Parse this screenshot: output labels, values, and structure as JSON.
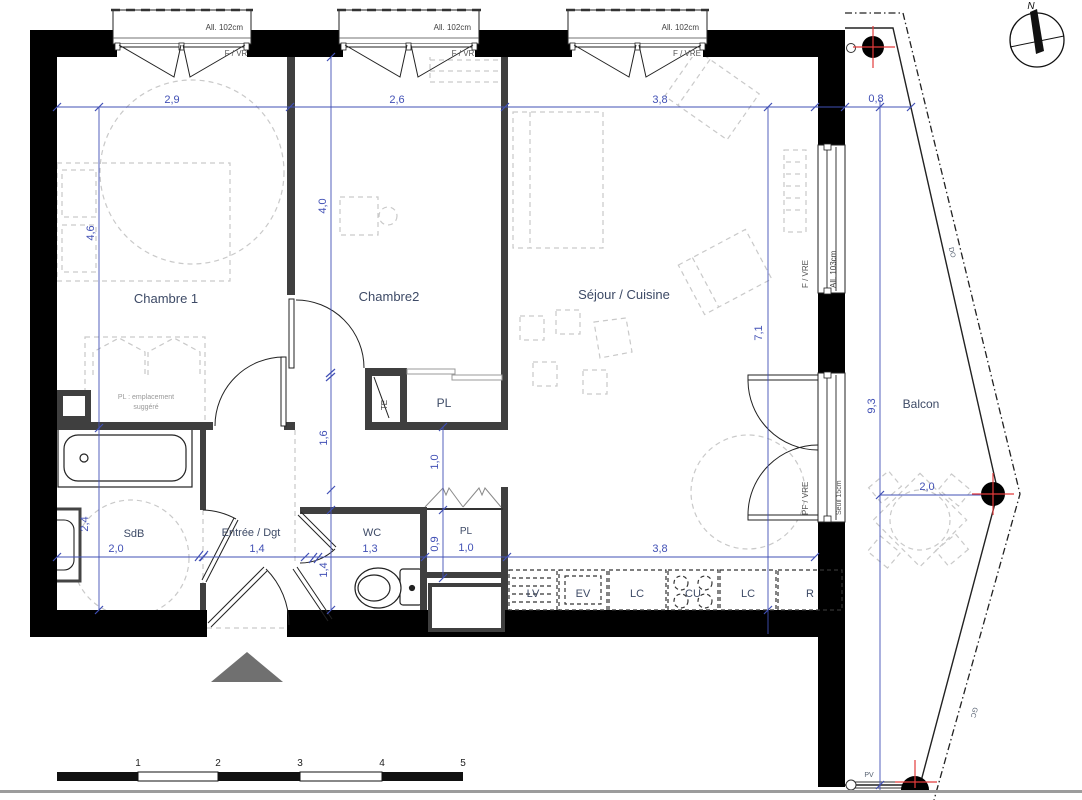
{
  "compass": {
    "label": "N"
  },
  "rooms": {
    "chambre1": "Chambre 1",
    "chambre2": "Chambre2",
    "sejour": "Séjour / Cuisine",
    "balcon": "Balcon",
    "sdb": "SdB",
    "entree": "Entrée / Dgt",
    "wc": "WC",
    "pl_chambre2": "PL",
    "pl_entree": "PL"
  },
  "openings": {
    "allege_102": "All. 102cm",
    "allege_103": "All. 103cm",
    "fvr": "F / VR",
    "fvre": "F / VRE",
    "pfvre": "PF / VRE",
    "seuil": "Seuil 15cm",
    "pv": "PV",
    "gc": "GC",
    "do": "DO"
  },
  "notes": {
    "te": "TE",
    "pl_sugg_1": "PL : emplacement",
    "pl_sugg_2": "suggéré"
  },
  "kitchen": {
    "units": [
      "LV",
      "EV",
      "LC",
      "CU",
      "LC",
      "R"
    ]
  },
  "dimensions": {
    "top": {
      "chambre1": "2,9",
      "chambre2": "2,6",
      "sejour": "3,8",
      "balcon": "0,8"
    },
    "left": {
      "chambre1": "4,6",
      "sdb": "2,4"
    },
    "middle": {
      "chambre2": "4,0",
      "hall": "1,6",
      "wc": "1,4"
    },
    "pl": {
      "depth_top": "1,0",
      "depth": "0,9"
    },
    "sejour_height": "7,1",
    "bottom": {
      "sdb": "2,0",
      "entree": "1,4",
      "wc": "1,3",
      "pl": "1,0",
      "cuisine": "3,8"
    },
    "balcon": {
      "height": "9,3",
      "width": "2,0"
    }
  },
  "scale_bar": {
    "labels": [
      "1",
      "2",
      "3",
      "4",
      "5"
    ]
  },
  "colors": {
    "wall": "#000000",
    "partition": "#3f3f3f",
    "dimension": "#4150b5",
    "furniture": "#c9c9c9",
    "label": "#3d4a66",
    "marker_red": "#e23b3b"
  }
}
